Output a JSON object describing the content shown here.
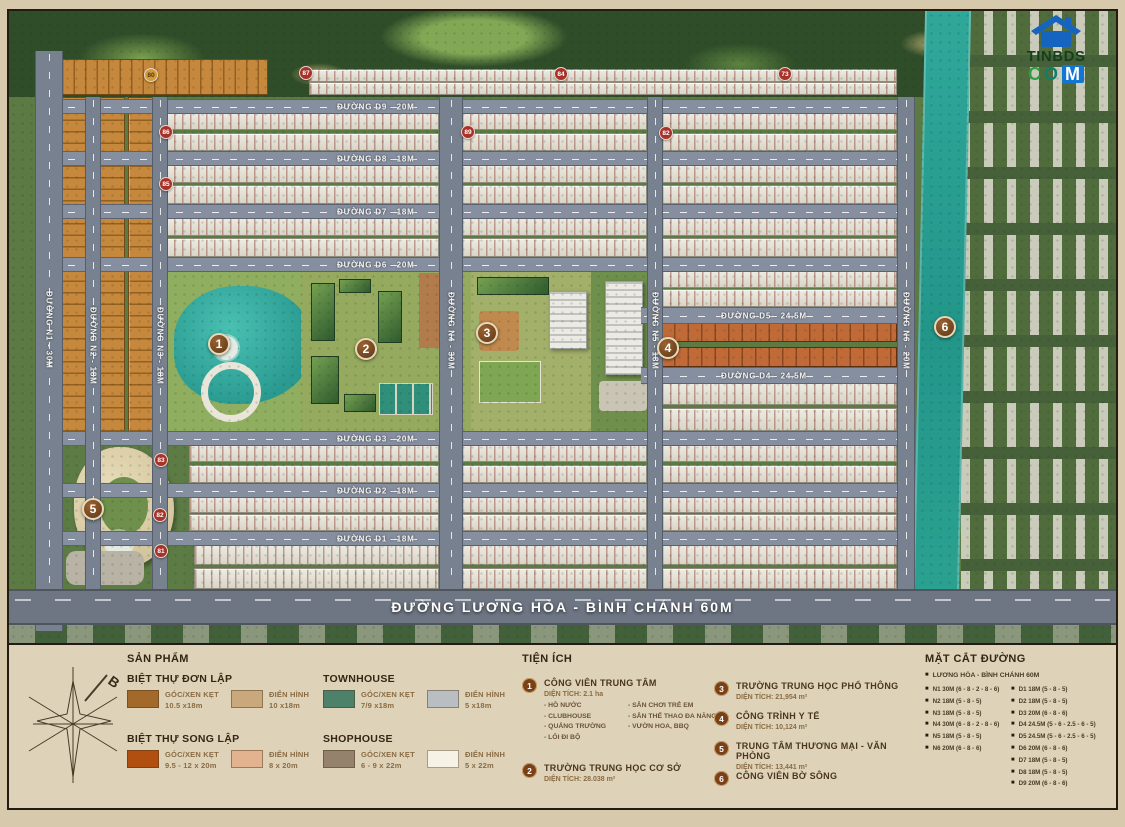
{
  "logo": {
    "line1": "TINBDS",
    "c": "C",
    "o": "O",
    "m": "M"
  },
  "compass": {
    "north": "B"
  },
  "map": {
    "main_road": {
      "label": "ĐƯỜNG LƯƠNG HÒA - BÌNH CHÁNH 60M"
    },
    "roads_h": [
      {
        "id": "d9",
        "label": "ĐƯỜNG D9 - 20M",
        "x": 38,
        "y": 88,
        "w": 866,
        "h": 13,
        "lx": 290
      },
      {
        "id": "d8",
        "label": "ĐƯỜNG D8 - 18M",
        "x": 38,
        "y": 140,
        "w": 866,
        "h": 13,
        "lx": 290
      },
      {
        "id": "d7",
        "label": "ĐƯỜNG D7 - 18M",
        "x": 38,
        "y": 193,
        "w": 866,
        "h": 13,
        "lx": 290
      },
      {
        "id": "d6",
        "label": "ĐƯỜNG D6 - 20M",
        "x": 38,
        "y": 246,
        "w": 866,
        "h": 13,
        "lx": 290
      },
      {
        "id": "d5",
        "label": "ĐƯỜNG D5 - 24.5M",
        "x": 632,
        "y": 296,
        "w": 272,
        "h": 15,
        "lx": 80
      },
      {
        "id": "d4",
        "label": "ĐƯỜNG D4 - 24.5M",
        "x": 632,
        "y": 356,
        "w": 272,
        "h": 15,
        "lx": 80
      },
      {
        "id": "d3",
        "label": "ĐƯỜNG D3 - 20M",
        "x": 38,
        "y": 420,
        "w": 866,
        "h": 13,
        "lx": 290
      },
      {
        "id": "d2",
        "label": "ĐƯỜNG D2 - 18M",
        "x": 38,
        "y": 472,
        "w": 866,
        "h": 13,
        "lx": 290
      },
      {
        "id": "d1",
        "label": "ĐƯỜNG D1 - 18M",
        "x": 38,
        "y": 520,
        "w": 866,
        "h": 13,
        "lx": 290
      }
    ],
    "roads_v": [
      {
        "id": "n1",
        "label": "ĐƯỜNG N1 - 30M",
        "x": 26,
        "y": 40,
        "w": 26,
        "h": 580,
        "ly": 240
      },
      {
        "id": "n2",
        "label": "ĐƯỜNG N2 - 18M",
        "x": 76,
        "y": 86,
        "w": 14,
        "h": 492,
        "ly": 210
      },
      {
        "id": "n3",
        "label": "ĐƯỜNG N3 - 18M",
        "x": 143,
        "y": 86,
        "w": 14,
        "h": 492,
        "ly": 210
      },
      {
        "id": "n4",
        "label": "ĐƯỜNG N4 - 30M",
        "x": 430,
        "y": 86,
        "w": 22,
        "h": 492,
        "ly": 195
      },
      {
        "id": "n5",
        "label": "ĐƯỜNG N5 - 18M",
        "x": 638,
        "y": 86,
        "w": 14,
        "h": 492,
        "ly": 195
      },
      {
        "id": "n6",
        "label": "ĐƯỜNG N6 - 20M",
        "x": 888,
        "y": 86,
        "w": 16,
        "h": 492,
        "ly": 195
      }
    ],
    "markers": [
      {
        "n": "1",
        "x": 210,
        "y": 333
      },
      {
        "n": "2",
        "x": 357,
        "y": 338
      },
      {
        "n": "3",
        "x": 478,
        "y": 322
      },
      {
        "n": "4",
        "x": 659,
        "y": 337
      },
      {
        "n": "5",
        "x": 84,
        "y": 498
      },
      {
        "n": "6",
        "x": 936,
        "y": 316
      }
    ],
    "badges": [
      {
        "n": "80",
        "x": 142,
        "y": 64,
        "variant": "gold"
      },
      {
        "n": "87",
        "x": 297,
        "y": 62
      },
      {
        "n": "84",
        "x": 552,
        "y": 63
      },
      {
        "n": "73",
        "x": 776,
        "y": 63
      },
      {
        "n": "86",
        "x": 157,
        "y": 121
      },
      {
        "n": "89",
        "x": 459,
        "y": 121
      },
      {
        "n": "82",
        "x": 657,
        "y": 122
      },
      {
        "n": "85",
        "x": 157,
        "y": 173
      },
      {
        "n": "83",
        "x": 152,
        "y": 449
      },
      {
        "n": "82",
        "x": 151,
        "y": 504
      },
      {
        "n": "81",
        "x": 152,
        "y": 540
      }
    ]
  },
  "legend": {
    "products": {
      "title": "SẢN PHẨM",
      "groups": [
        {
          "name": "BIỆT THỰ ĐƠN LẬP",
          "items": [
            {
              "type": "GÓC/XEN KẸT",
              "size": "10.5 x18m",
              "color": "#a2692a"
            },
            {
              "type": "ĐIỂN HÌNH",
              "size": "10 x18m",
              "color": "#c9a97c"
            }
          ]
        },
        {
          "name": "BIỆT THỰ SONG LẬP",
          "items": [
            {
              "type": "GÓC/XEN KẸT",
              "size": "9.5 - 12 x 20m",
              "color": "#b04f10"
            },
            {
              "type": "ĐIỂN HÌNH",
              "size": "8 x 20m",
              "color": "#e3b28e"
            }
          ]
        },
        {
          "name": "TOWNHOUSE",
          "items": [
            {
              "type": "GÓC/XEN KẸT",
              "size": "7/9 x18m",
              "color": "#4d8169"
            },
            {
              "type": "ĐIỂN HÌNH",
              "size": "5 x18m",
              "color": "#b8bec1"
            }
          ]
        },
        {
          "name": "SHOPHOUSE",
          "items": [
            {
              "type": "GÓC/XEN KẸT",
              "size": "6 - 9 x 22m",
              "color": "#94826c"
            },
            {
              "type": "ĐIỂN HÌNH",
              "size": "5 x 22m",
              "color": "#f7f2e6"
            }
          ]
        }
      ]
    },
    "amenities": {
      "title": "TIỆN ÍCH",
      "items": [
        {
          "n": "1",
          "name": "CÔNG VIÊN TRUNG TÂM",
          "area": "DIỆN TÍCH: 2.1 ha",
          "details_col1": [
            "- HỒ NƯỚC",
            "- CLUBHOUSE",
            "- QUẢNG TRƯỜNG",
            "- LỐI ĐI BỘ"
          ],
          "details_col2": [
            "- SÂN CHƠI TRẺ EM",
            "- SÂN THỂ THAO ĐA NĂNG",
            "- VƯỜN HOA, BBQ"
          ]
        },
        {
          "n": "2",
          "name": "TRƯỜNG TRUNG HỌC CƠ SỞ",
          "area": "DIỆN TÍCH: 28.038 m²"
        },
        {
          "n": "3",
          "name": "TRƯỜNG TRUNG HỌC PHỔ THÔNG",
          "area": "DIỆN TÍCH: 21,954 m²"
        },
        {
          "n": "4",
          "name": "CÔNG TRÌNH Y TẾ",
          "area": "DIỆN TÍCH: 10,124 m²"
        },
        {
          "n": "5",
          "name": "TRUNG TÂM THƯƠNG MẠI - VĂN PHÒNG",
          "area": "DIỆN TÍCH: 13,441 m²"
        },
        {
          "n": "6",
          "name": "CÔNG VIÊN BỜ SÔNG",
          "area": ""
        }
      ]
    },
    "sections": {
      "title": "MẶT CẮT ĐƯỜNG",
      "full": "LƯƠNG HÒA - BÌNH CHÁNH 60M",
      "col1": [
        "N1 30M (6 - 8 - 2 - 8 - 6)",
        "N2 18M (5 - 8 - 5)",
        "N3 18M (5 - 8 - 5)",
        "N4 30M (6 - 8 - 2 - 8 - 6)",
        "N5 18M (5 - 8 - 5)",
        "N6 20M (6 - 8 - 6)"
      ],
      "col2": [
        "D1 18M (5 - 8 - 5)",
        "D2 18M (5 - 8 - 5)",
        "D3 20M (6 - 8 - 6)",
        "D4 24.5M (5 - 6 - 2.5 - 6 - 5)",
        "D5 24.5M (5 - 6 - 2.5 - 6 - 5)",
        "D6 20M (6 - 8 - 6)",
        "D7 18M (5 - 8 - 5)",
        "D8 18M (5 - 8 - 5)",
        "D9 20M (6 - 8 - 6)"
      ]
    }
  }
}
